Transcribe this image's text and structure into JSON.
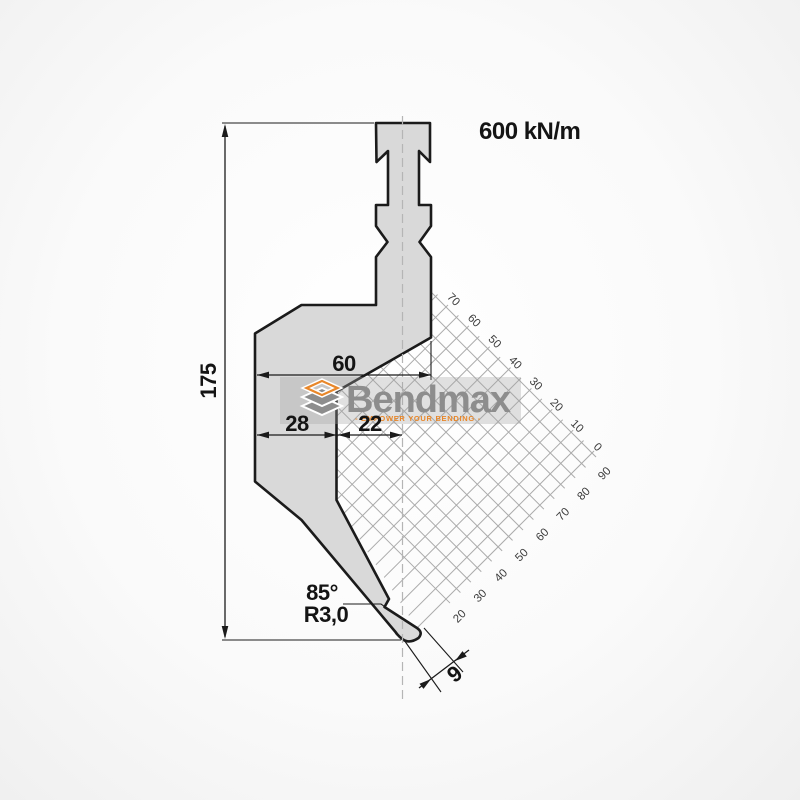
{
  "drawing": {
    "force_rating": "600 kN/m",
    "dimensions": {
      "total_height": "175",
      "body_width": "60",
      "back_width": "28",
      "tip_offset": "22",
      "tip_angle": "85°",
      "tip_radius": "R3,0",
      "tip_land": "9"
    },
    "grid": {
      "scale_top_labels": [
        "70",
        "60",
        "50",
        "40",
        "30",
        "20",
        "10",
        "0"
      ],
      "scale_bottom_labels": [
        "90",
        "80",
        "70",
        "60",
        "50",
        "40",
        "30",
        "20"
      ]
    },
    "logo": {
      "name": "Bendmax",
      "tagline": "- EMPOWER YOUR BENDING -"
    },
    "colors": {
      "punch_fill": "#d9d9d9",
      "outline": "#1b1b1b",
      "grid_line": "#ababab",
      "logo_gray": "#8d8d8d",
      "logo_orange": "#e8872a"
    }
  }
}
